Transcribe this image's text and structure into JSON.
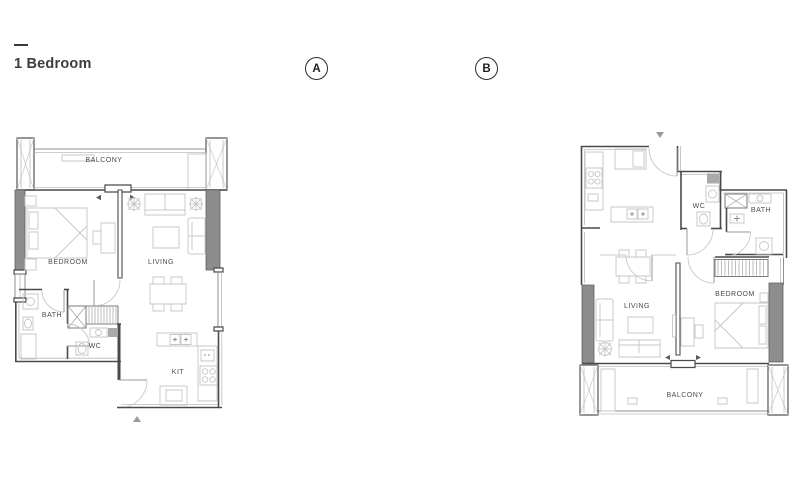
{
  "header": {
    "title": "1 Bedroom"
  },
  "variants": {
    "a": "A",
    "b": "B"
  },
  "plans": {
    "a": {
      "balcony": "BALCONY",
      "bedroom": "BEDROOM",
      "living": "LIVING",
      "bath": "BATH",
      "wc": "WC",
      "kitchen": "KIT"
    },
    "b": {
      "balcony": "BALCONY",
      "bedroom": "BEDROOM",
      "living": "LIVING",
      "bath": "BATH",
      "wc": "WC",
      "kitchen": "KIT"
    }
  },
  "colors": {
    "background": "#ffffff",
    "wall_fill": "#8d8d8d",
    "wall_line": "#4a4a4a",
    "furniture_line": "#c5c5c5",
    "label_text": "#4c4c4c"
  }
}
